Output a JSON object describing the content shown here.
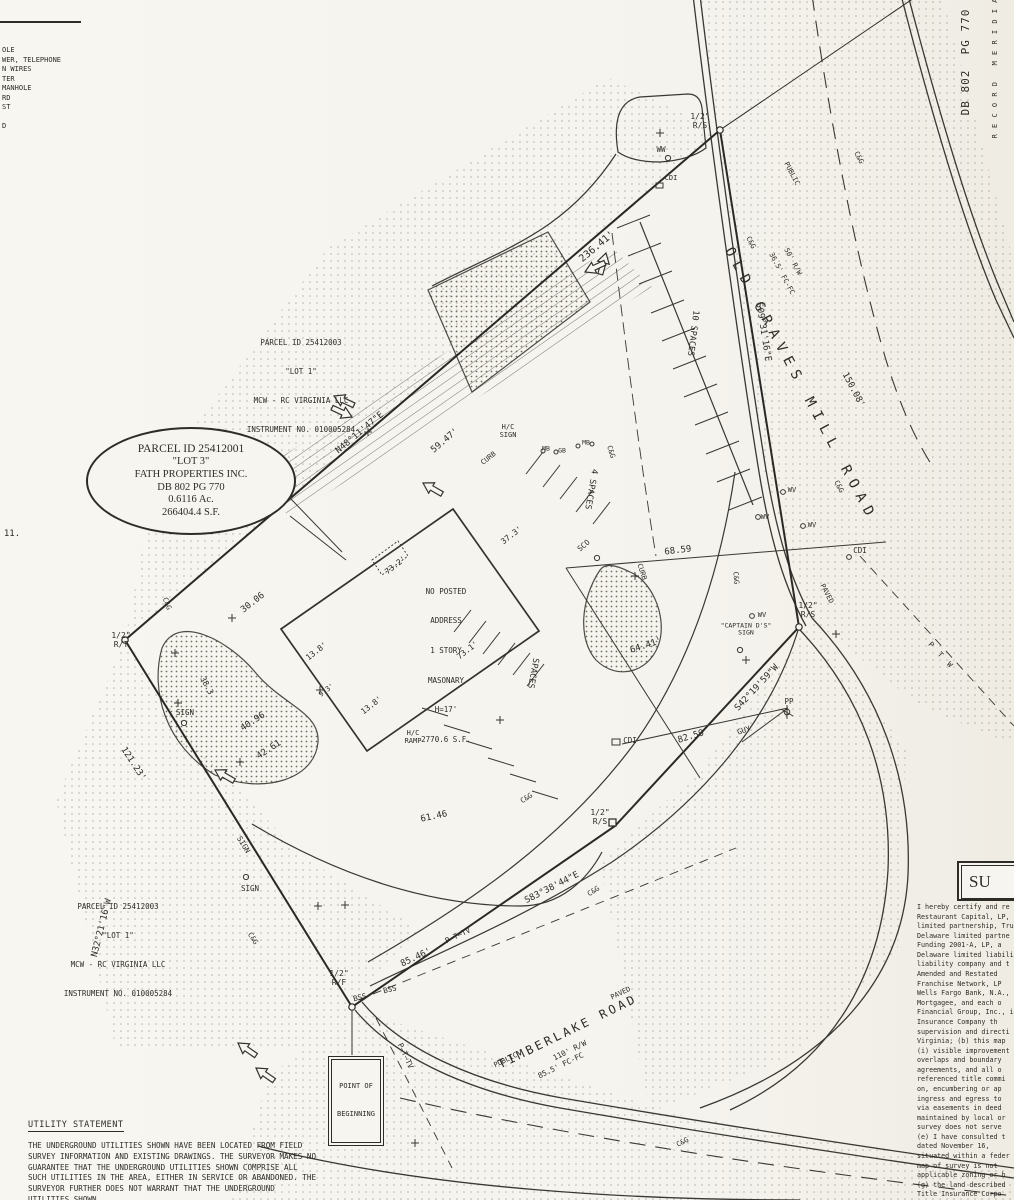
{
  "legend": {
    "lines": [
      "OLE",
      "WER, TELEPHONE",
      "N WIRES",
      "TER",
      "MANHOLE",
      "RD",
      "ST",
      "D"
    ],
    "stray_note": "11."
  },
  "parcel_lot1": {
    "lines": [
      "PARCEL ID 25412003",
      "\"LOT 1\"",
      "MCW - RC VIRGINIA LLC",
      "INSTRUMENT NO. 010005284"
    ]
  },
  "callout_lot3": {
    "lines": [
      "PARCEL ID 25412001",
      "\"LOT 3\"",
      "FATH PROPERTIES INC.",
      "DB 802  PG 770",
      "0.6116 Ac.",
      "266404.4 S.F."
    ]
  },
  "building": {
    "lines": [
      "NO POSTED",
      "ADDRESS",
      "1 STORY",
      "MASONARY",
      "H=17'",
      "2770.6 S.F."
    ]
  },
  "pob": {
    "lines": [
      "POINT OF",
      "BEGINNING"
    ]
  },
  "margin": {
    "db": "DB 802  PG 770",
    "meridian": "R E C O R D   M E R I D I A"
  },
  "utility": {
    "title": "UTILITY STATEMENT",
    "body": "THE UNDERGROUND UTILITIES SHOWN HAVE BEEN LOCATED FROM FIELD SURVEY INFORMATION AND EXISTING DRAWINGS.  THE SURVEYOR MAKES NO GUARANTEE THAT THE UNDERGROUND UTILITIES SHOWN COMPRISE ALL SUCH UTILITIES IN THE AREA, EITHER IN SERVICE OR ABANDONED.  THE SURVEYOR FURTHER DOES NOT WARRANT THAT THE UNDERGROUND UTILITIES SHOWN"
  },
  "certificate": {
    "header": "SU",
    "body": "I hereby certify and re\nRestaurant Capital, LP,\nlimited partnership, Tru\nDelaware limited partne\nFunding 2001-A, LP, a\nDelaware limited liability\nliability company and t\nAmended and Restated\nFranchise Network, LP\nWells Fargo Bank, N.A.,\nMortgagee, and each o\nFinancial Group, Inc., i\nInsurance Company th\nsupervision and directi\nVirginia; (b) this map\n(i) visible improvement\noverlaps and boundary\nagreements, and all o\nreferenced title commi\non, encumbering or ap\ningress and egress to\nvia easements in deed\nmaintained by local or\nsurvey does not serve\n(e) I have consulted t\ndated November 16,\nsituated within a feder\nmap of survey is not\napplicable zoning or b\n(g) the land described\nTitle Insurance Corpo"
  },
  "plan": {
    "labels": [
      {
        "n": "dim-236-41",
        "t": "236.41'",
        "x": 597,
        "y": 247,
        "r": -40,
        "s": 10
      },
      {
        "n": "bearing-n48",
        "t": "N48°11'47\"E",
        "x": 360,
        "y": 433,
        "r": -40,
        "s": 9
      },
      {
        "n": "dim-59-47",
        "t": "59.47'",
        "x": 445,
        "y": 441,
        "r": -40,
        "s": 9
      },
      {
        "n": "bearing-s09",
        "t": "S09°31'16\"E",
        "x": 763,
        "y": 332,
        "r": 81,
        "s": 9
      },
      {
        "n": "dim-150-08",
        "t": "150.08'",
        "x": 853,
        "y": 390,
        "r": 62,
        "s": 9
      },
      {
        "n": "bearing-s42",
        "t": "S42°19'59\"W",
        "x": 757,
        "y": 688,
        "r": -47,
        "s": 9
      },
      {
        "n": "bearing-s83",
        "t": "S83°38'44\"E",
        "x": 552,
        "y": 888,
        "r": -27,
        "s": 9
      },
      {
        "n": "bearing-n32",
        "t": "N32°21'16\"W",
        "x": 102,
        "y": 928,
        "r": -76,
        "s": 9
      },
      {
        "n": "dim-121-23",
        "t": "121.23'",
        "x": 133,
        "y": 764,
        "r": 57,
        "s": 9
      },
      {
        "n": "dim-85-46",
        "t": "85.46'",
        "x": 416,
        "y": 958,
        "r": -25,
        "s": 9
      },
      {
        "n": "dim-61-46",
        "t": "61.46",
        "x": 434,
        "y": 817,
        "r": -12,
        "s": 9
      },
      {
        "n": "dim-68-59",
        "t": "68.59",
        "x": 678,
        "y": 551,
        "r": -7,
        "s": 9
      },
      {
        "n": "dim-64-41",
        "t": "64.41'",
        "x": 646,
        "y": 646,
        "r": -18,
        "s": 9
      },
      {
        "n": "dim-82-59",
        "t": "82.59",
        "x": 691,
        "y": 737,
        "r": -17,
        "s": 9
      },
      {
        "n": "dim-30-06",
        "t": "30.06",
        "x": 253,
        "y": 603,
        "r": -38,
        "s": 9
      },
      {
        "n": "dim-40-96",
        "t": "40.96",
        "x": 253,
        "y": 722,
        "r": -33,
        "s": 9
      },
      {
        "n": "dim-42-61",
        "t": "42.61",
        "x": 269,
        "y": 750,
        "r": -33,
        "s": 9
      },
      {
        "n": "dim-38-3",
        "t": "38.3",
        "x": 206,
        "y": 686,
        "r": 62,
        "s": 8
      },
      {
        "n": "dim-37-3",
        "t": "37.3'",
        "x": 512,
        "y": 536,
        "r": -38,
        "s": 8
      },
      {
        "n": "dim-73-2",
        "t": "73.2'",
        "x": 396,
        "y": 566,
        "r": -38,
        "s": 8
      },
      {
        "n": "dim-73-1",
        "t": "73.1'",
        "x": 468,
        "y": 651,
        "r": -38,
        "s": 8
      },
      {
        "n": "dim-13-8-a",
        "t": "13.8'",
        "x": 317,
        "y": 652,
        "r": -38,
        "s": 8
      },
      {
        "n": "dim-13-8-b",
        "t": "13.8'",
        "x": 372,
        "y": 706,
        "r": -38,
        "s": 8
      },
      {
        "n": "dim-9-3",
        "t": "9.3'",
        "x": 327,
        "y": 691,
        "r": -38,
        "s": 7
      },
      {
        "n": "marker-rs-top",
        "t": "1/2\"\nR/S",
        "x": 700,
        "y": 122,
        "r": 0,
        "s": 8
      },
      {
        "n": "marker-rs-right",
        "t": "1/2\"\nR/S",
        "x": 808,
        "y": 611,
        "r": 0,
        "s": 8
      },
      {
        "n": "marker-rs-bottom",
        "t": "1/2\"\nR/S",
        "x": 600,
        "y": 818,
        "r": 0,
        "s": 8
      },
      {
        "n": "marker-rt-west",
        "t": "1/2\"\nR/T",
        "x": 121,
        "y": 641,
        "r": 0,
        "s": 8
      },
      {
        "n": "marker-rf-pob",
        "t": "1/2\"\nR/F",
        "x": 339,
        "y": 979,
        "r": 0,
        "s": 8
      },
      {
        "n": "label-ww",
        "t": "WW",
        "x": 661,
        "y": 150,
        "r": 0,
        "s": 7.5
      },
      {
        "n": "label-cdi-top",
        "t": "CDI",
        "x": 671,
        "y": 179,
        "r": 0,
        "s": 7
      },
      {
        "n": "label-cdi-right",
        "t": "CDI",
        "x": 860,
        "y": 551,
        "r": 0,
        "s": 7.5
      },
      {
        "n": "label-cdi-mid",
        "t": "CDI",
        "x": 630,
        "y": 741,
        "r": 0,
        "s": 7.5
      },
      {
        "n": "label-sco",
        "t": "SCO",
        "x": 584,
        "y": 546,
        "r": -40,
        "s": 7.5
      },
      {
        "n": "label-wv-1",
        "t": "WV",
        "x": 792,
        "y": 491,
        "r": 0,
        "s": 7
      },
      {
        "n": "label-wv-2",
        "t": "WV",
        "x": 765,
        "y": 518,
        "r": 0,
        "s": 7
      },
      {
        "n": "label-wv-3",
        "t": "WV",
        "x": 812,
        "y": 526,
        "r": 0,
        "s": 7
      },
      {
        "n": "label-wv-4",
        "t": "WV",
        "x": 762,
        "y": 616,
        "r": 0,
        "s": 7
      },
      {
        "n": "label-captain-ds-sign",
        "t": "\"CAPTAIN D'S\"\nSIGN",
        "x": 746,
        "y": 630,
        "r": 0,
        "s": 6.5
      },
      {
        "n": "label-pp",
        "t": "PP",
        "x": 789,
        "y": 702,
        "r": 0,
        "s": 7.5
      },
      {
        "n": "label-guy",
        "t": "GUY",
        "x": 744,
        "y": 731,
        "r": -18,
        "s": 7.5
      },
      {
        "n": "label-bss-1",
        "t": "BSS",
        "x": 360,
        "y": 998,
        "r": -14,
        "s": 7.5
      },
      {
        "n": "label-bss-2",
        "t": "BSS",
        "x": 390,
        "y": 990,
        "r": -14,
        "s": 7.5
      },
      {
        "n": "label-sign-island",
        "t": "SIGN",
        "x": 185,
        "y": 713,
        "r": 0,
        "s": 7.5
      },
      {
        "n": "label-sign-rot",
        "t": "SIGN",
        "x": 243,
        "y": 845,
        "r": 58,
        "s": 7.5
      },
      {
        "n": "label-sign-low",
        "t": "SIGN",
        "x": 250,
        "y": 889,
        "r": 0,
        "s": 7.5
      },
      {
        "n": "label-hc-sign",
        "t": "H/C\nSIGN",
        "x": 508,
        "y": 432,
        "r": 0,
        "s": 7
      },
      {
        "n": "label-hc-ramp",
        "t": "H/C\nRAMP",
        "x": 413,
        "y": 738,
        "r": 0,
        "s": 7
      },
      {
        "n": "label-mb-1",
        "t": "MB",
        "x": 546,
        "y": 449,
        "r": 0,
        "s": 6.5
      },
      {
        "n": "label-gb",
        "t": "GB",
        "x": 562,
        "y": 451,
        "r": 0,
        "s": 6.5
      },
      {
        "n": "label-mb-2",
        "t": "MB",
        "x": 586,
        "y": 443,
        "r": 0,
        "s": 6.5
      },
      {
        "n": "label-curb-a",
        "t": "CURB",
        "x": 489,
        "y": 459,
        "r": -38,
        "s": 7
      },
      {
        "n": "label-curb-b",
        "t": "CURB",
        "x": 641,
        "y": 572,
        "r": 72,
        "s": 7
      },
      {
        "n": "label-10-spaces",
        "t": "10 SPACES",
        "x": 692,
        "y": 333,
        "r": 97,
        "s": 8.5
      },
      {
        "n": "label-4-spaces",
        "t": "4 SPACES",
        "x": 590,
        "y": 489,
        "r": 100,
        "s": 8.5
      },
      {
        "n": "label-spaces",
        "t": "SPACES",
        "x": 532,
        "y": 673,
        "r": 100,
        "s": 8.5
      },
      {
        "n": "label-ptv-1",
        "t": "P—T—TV",
        "x": 458,
        "y": 936,
        "r": -25,
        "s": 7.5
      },
      {
        "n": "label-ptv-2",
        "t": "P—T—TV",
        "x": 405,
        "y": 1056,
        "r": 65,
        "s": 7.5
      },
      {
        "n": "label-ptw",
        "t": "P  T  W",
        "x": 940,
        "y": 655,
        "r": 47,
        "s": 7.5
      },
      {
        "n": "note-11",
        "t": "11.",
        "x": 12,
        "y": 534,
        "r": 0,
        "s": 9
      },
      {
        "n": "label-cg-1",
        "t": "C&G",
        "x": 858,
        "y": 158,
        "r": 62,
        "s": 7
      },
      {
        "n": "label-cg-2",
        "t": "C&G",
        "x": 750,
        "y": 243,
        "r": 62,
        "s": 7
      },
      {
        "n": "label-cg-3",
        "t": "C&G",
        "x": 610,
        "y": 452,
        "r": 73,
        "s": 7
      },
      {
        "n": "label-cg-4",
        "t": "C&G",
        "x": 838,
        "y": 487,
        "r": 62,
        "s": 7
      },
      {
        "n": "label-cg-5",
        "t": "C&G",
        "x": 735,
        "y": 578,
        "r": 85,
        "s": 7
      },
      {
        "n": "label-cg-6",
        "t": "C&G",
        "x": 527,
        "y": 799,
        "r": -33,
        "s": 7
      },
      {
        "n": "label-cg-7",
        "t": "C&G",
        "x": 594,
        "y": 892,
        "r": -33,
        "s": 7
      },
      {
        "n": "label-cg-8",
        "t": "C&G",
        "x": 252,
        "y": 939,
        "r": 57,
        "s": 7
      },
      {
        "n": "label-cg-9",
        "t": "C&G",
        "x": 683,
        "y": 1143,
        "r": -28,
        "s": 7
      },
      {
        "n": "label-cg-10",
        "t": "C&G",
        "x": 166,
        "y": 604,
        "r": 68,
        "s": 7
      },
      {
        "n": "road-og-public",
        "t": "PUBLIC",
        "x": 791,
        "y": 174,
        "r": 62,
        "s": 7
      },
      {
        "n": "road-og-name",
        "t": "OLD GRAVES MILL ROAD",
        "x": 800,
        "y": 385,
        "r": 62,
        "s": 14,
        "ls": 7
      },
      {
        "n": "road-og-rw",
        "t": "50' R/W",
        "x": 792,
        "y": 262,
        "r": 62,
        "s": 7
      },
      {
        "n": "road-og-fc",
        "t": "36.5' FC-FC",
        "x": 781,
        "y": 274,
        "r": 62,
        "s": 7
      },
      {
        "n": "road-og-paved",
        "t": "PAVED",
        "x": 826,
        "y": 594,
        "r": 62,
        "s": 7
      },
      {
        "n": "road-tl-name",
        "t": "TIMBERLAKE ROAD",
        "x": 568,
        "y": 1032,
        "r": -26,
        "s": 12,
        "ls": 3
      },
      {
        "n": "road-tl-public",
        "t": "PUBLIC",
        "x": 506,
        "y": 1061,
        "r": -26,
        "s": 7
      },
      {
        "n": "road-tl-paved",
        "t": "PAVED",
        "x": 621,
        "y": 994,
        "r": -26,
        "s": 7
      },
      {
        "n": "road-tl-rw",
        "t": "110' R/W",
        "x": 570,
        "y": 1051,
        "r": -26,
        "s": 7.5
      },
      {
        "n": "road-tl-fc",
        "t": "85.5' FC-FC",
        "x": 561,
        "y": 1066,
        "r": -26,
        "s": 7.5
      },
      {
        "n": "margin-db-802",
        "t": "DB 802  PG 770",
        "x": 966,
        "y": 62,
        "r": -90,
        "s": 11,
        "ls": 1
      },
      {
        "n": "margin-record-meridian",
        "t": "R E C O R D   M E R I D I A",
        "x": 996,
        "y": 68,
        "r": -90,
        "s": 7,
        "ls": 1
      }
    ]
  }
}
